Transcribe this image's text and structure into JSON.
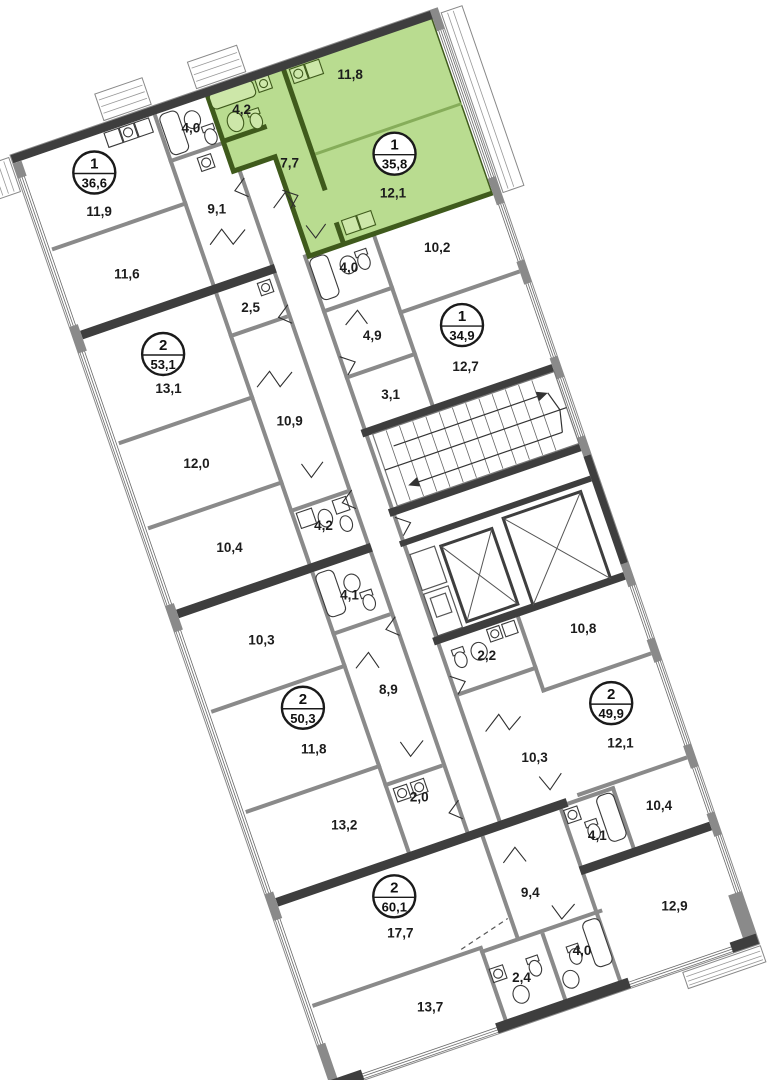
{
  "plan_type": "residential-floor-plan",
  "colors": {
    "highlight": "#b9dc90",
    "highlight_wall": "#3f5a1c",
    "wall_dark": "#3e3e3e",
    "wall_gray": "#8a8a8a"
  },
  "units": [
    {
      "name": "apartment-35-8-highlighted",
      "badge": {
        "rooms": "1",
        "area": "35,8"
      },
      "rooms": [
        {
          "area": "4,2"
        },
        {
          "area": "11,8"
        },
        {
          "area": "7,7"
        },
        {
          "area": "12,1"
        }
      ]
    },
    {
      "name": "apartment-36-6",
      "badge": {
        "rooms": "1",
        "area": "36,6"
      },
      "rooms": [
        {
          "area": "4,0"
        },
        {
          "area": "11,9"
        },
        {
          "area": "9,1"
        },
        {
          "area": "11,6"
        }
      ]
    },
    {
      "name": "apartment-53-1",
      "badge": {
        "rooms": "2",
        "area": "53,1"
      },
      "rooms": [
        {
          "area": "2,5"
        },
        {
          "area": "13,1"
        },
        {
          "area": "10,9"
        },
        {
          "area": "12,0"
        },
        {
          "area": "10,4"
        },
        {
          "area": "4,2"
        }
      ]
    },
    {
      "name": "apartment-50-3",
      "badge": {
        "rooms": "2",
        "area": "50,3"
      },
      "rooms": [
        {
          "area": "4,1"
        },
        {
          "area": "10,3"
        },
        {
          "area": "8,9"
        },
        {
          "area": "11,8"
        },
        {
          "area": "13,2"
        },
        {
          "area": "2,0"
        }
      ]
    },
    {
      "name": "apartment-60-1",
      "badge": {
        "rooms": "2",
        "area": "60,1"
      },
      "rooms": [
        {
          "area": "17,7"
        },
        {
          "area": "13,7"
        },
        {
          "area": "9,4"
        },
        {
          "area": "2,4"
        },
        {
          "area": "4,0"
        },
        {
          "area": "12,9"
        }
      ]
    },
    {
      "name": "apartment-34-9",
      "badge": {
        "rooms": "1",
        "area": "34,9"
      },
      "rooms": [
        {
          "area": "4,0"
        },
        {
          "area": "10,2"
        },
        {
          "area": "4,9"
        },
        {
          "area": "3,1"
        },
        {
          "area": "12,7"
        }
      ]
    },
    {
      "name": "apartment-49-9",
      "badge": {
        "rooms": "2",
        "area": "49,9"
      },
      "rooms": [
        {
          "area": "2,2"
        },
        {
          "area": "10,8"
        },
        {
          "area": "10,3"
        },
        {
          "area": "12,1"
        },
        {
          "area": "10,4"
        },
        {
          "area": "4,1"
        }
      ]
    }
  ]
}
